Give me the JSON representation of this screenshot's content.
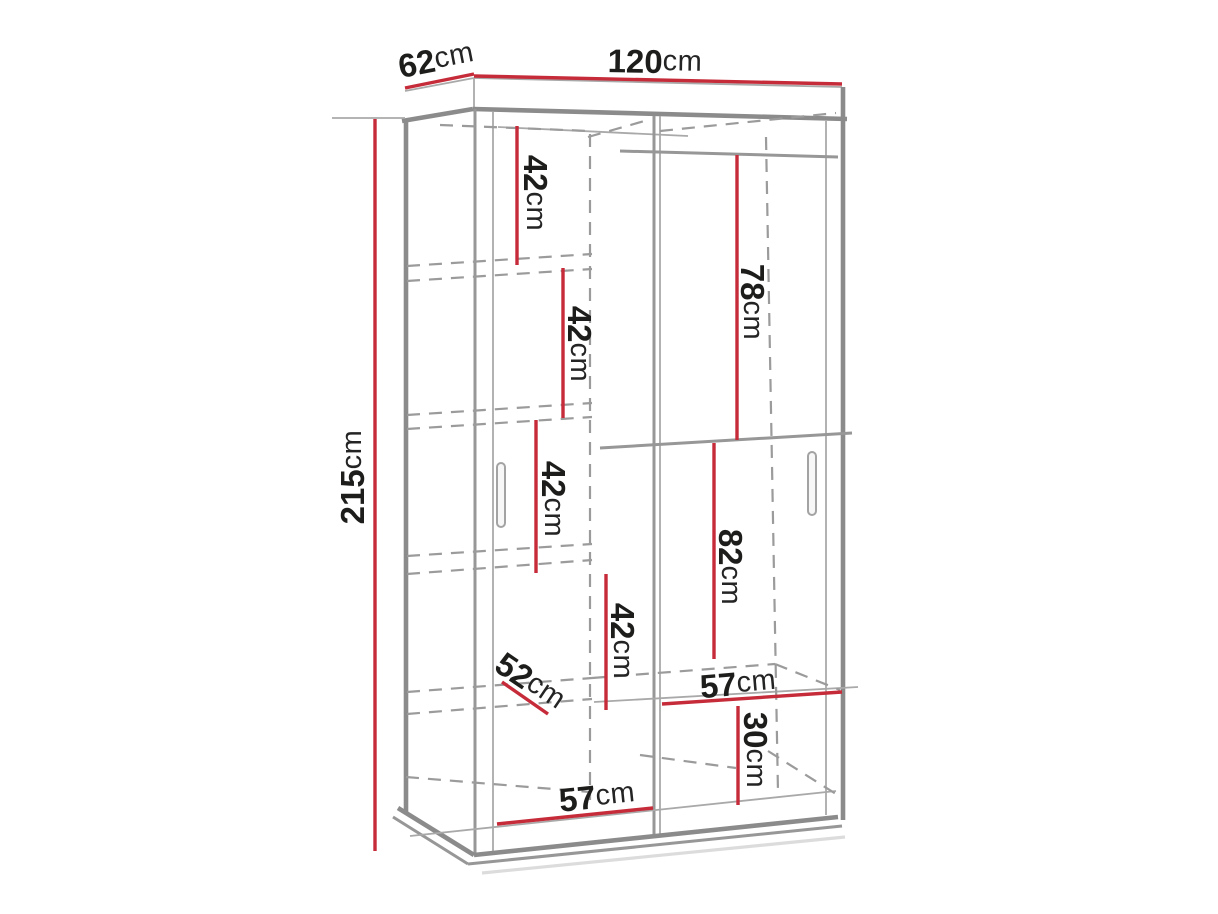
{
  "diagram": {
    "type": "furniture-dimension-drawing",
    "subject": "sliding-door wardrobe with internal shelves and hanging sections",
    "colors": {
      "dimension_red": "#c62b39",
      "outline_gray": "#8b8b8b",
      "dashed_gray": "#9b9b9b",
      "text": "#1d1d1b",
      "background": "#ffffff"
    },
    "labels": [
      {
        "name": "depth",
        "value": "62",
        "unit": "cm"
      },
      {
        "name": "width",
        "value": "120",
        "unit": "cm"
      },
      {
        "name": "height",
        "value": "215",
        "unit": "cm"
      },
      {
        "name": "shelf-gap-1",
        "value": "42",
        "unit": "cm"
      },
      {
        "name": "shelf-gap-2",
        "value": "42",
        "unit": "cm"
      },
      {
        "name": "shelf-gap-3",
        "value": "42",
        "unit": "cm"
      },
      {
        "name": "shelf-gap-4",
        "value": "42",
        "unit": "cm"
      },
      {
        "name": "hanging-space",
        "value": "78",
        "unit": "cm"
      },
      {
        "name": "lower-space",
        "value": "82",
        "unit": "cm"
      },
      {
        "name": "bottom-space",
        "value": "30",
        "unit": "cm"
      },
      {
        "name": "right-shelf-width",
        "value": "57",
        "unit": "cm"
      },
      {
        "name": "left-shelf-width",
        "value": "57",
        "unit": "cm"
      },
      {
        "name": "shelf-depth",
        "value": "52",
        "unit": "cm"
      }
    ]
  }
}
